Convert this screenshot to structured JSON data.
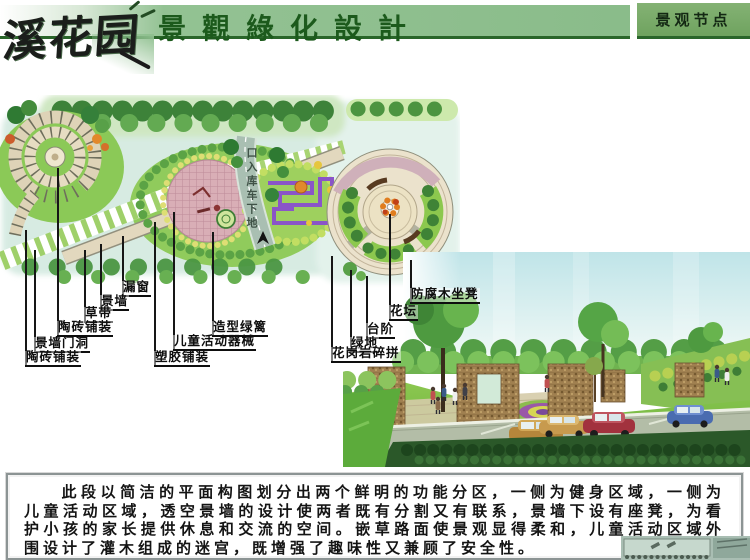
{
  "header": {
    "logo": "溪花园",
    "title": "景觀綠化設計",
    "corner_tab": "景观节点"
  },
  "plan": {
    "road_text": "口入库车下地",
    "labels_left": [
      "漏窗",
      "景墙",
      "草带",
      "陶砖铺装",
      "景墙门洞",
      "陶砖铺装",
      "塑胶铺装",
      "儿童活动器械",
      "造型绿篱"
    ],
    "labels_right": [
      "防腐木坐凳",
      "花坛",
      "台阶",
      "绿地",
      "花岗岩碎拼"
    ]
  },
  "description": {
    "paragraph": "此段以简洁的平面构图划分出两个鲜明的功能分区，一侧为健身区域，一侧为儿童活动区域，透空景墙的设计使两者既有分割又有联系，景墙下设有座凳，为看护小孩的家长提供休息和交流的空间。嵌草路面使景观显得柔和，儿童活动区域外围设计了灌木组成的迷宫，既增强了趣味性又兼顾了安全性。"
  },
  "colors": {
    "banner_green": "#8abc8a",
    "banner_edge": "#2a662a",
    "title_green": "#1c5a1c",
    "corner_green": "#6fa35f",
    "label_ink": "#0e0e0e"
  }
}
